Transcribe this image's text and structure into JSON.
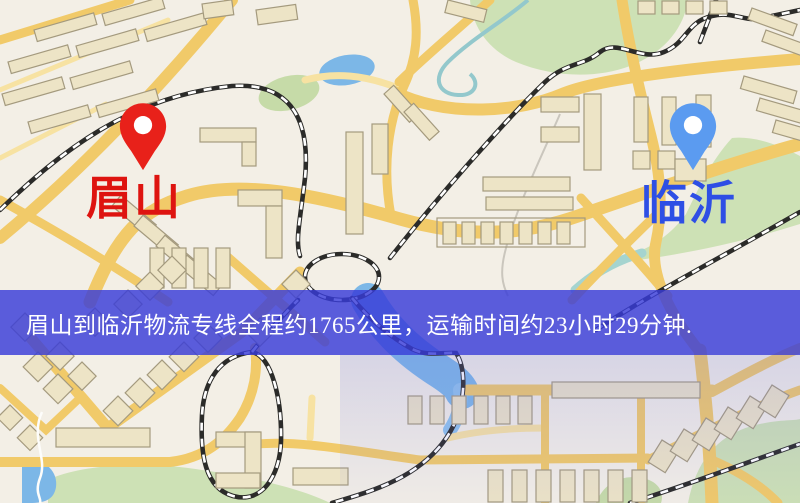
{
  "page": {
    "width": 800,
    "height": 503,
    "type": "logistics-route-map"
  },
  "banner": {
    "text": "眉山到临沂物流专线全程约1765公里，运输时间约23小时29分钟.",
    "background_color": "rgba(56,60,216,0.82)",
    "text_color": "#ffffff"
  },
  "markers": {
    "origin": {
      "label": "眉山",
      "pin_color": "#e8211a",
      "label_color": "#de1410"
    },
    "destination": {
      "label": "临沂",
      "pin_color": "#5b9bf0",
      "label_color": "#2e4fe5"
    }
  },
  "route_info": {
    "origin": "眉山",
    "destination": "临沂",
    "distance_text": "约1765公里",
    "duration_text": "约23小时29分钟"
  },
  "map_colors": {
    "background": "#f3efe6",
    "road": "#f1ca69",
    "road_minor": "#f7e2a2",
    "park": "#cde1b5",
    "water": "#7cb7e7",
    "railway": "#2b2b29",
    "building_fill": "#ede4c6",
    "building_outline": "#a49a7e"
  }
}
